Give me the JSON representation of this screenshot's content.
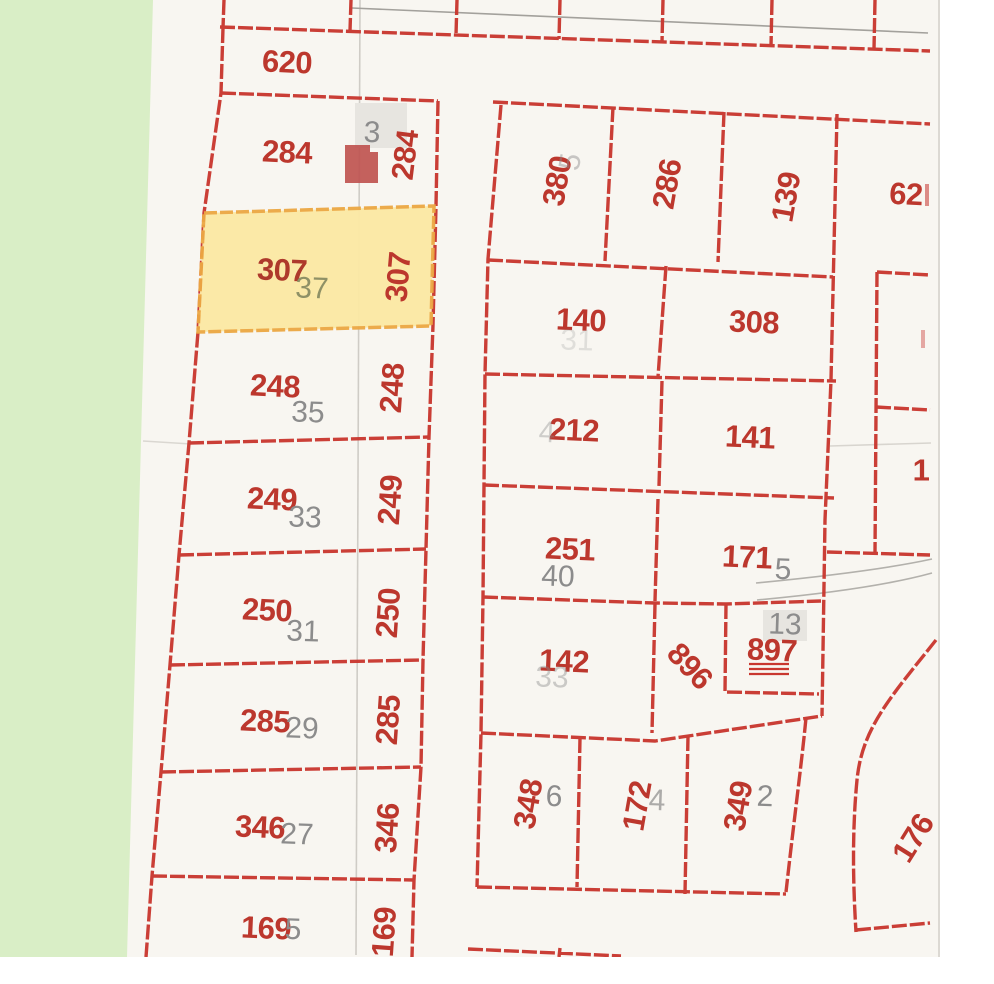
{
  "map": {
    "kind": "cadastral parcel map",
    "highlighted_parcel": {
      "parcel_number": "307",
      "house_number": "37"
    },
    "colors": {
      "map_background": "#f8f6f1",
      "parcel_line": "#c9372f",
      "parcel_label": "#bc372d",
      "house_number_label": "#8c8c8c",
      "house_number_on_highlight": "#8f9166",
      "highlight_fill": "#fce9a4",
      "highlight_border": "#eca843",
      "greenspace": "#d9eec6",
      "road_line": "#b3b1ac",
      "grid_line": "#cfccc6",
      "building_fill": "#bf5450"
    },
    "parcel_numbers": {
      "p620": "620",
      "p284": "284",
      "p284v": "284",
      "p307": "307",
      "p307v": "307",
      "p248": "248",
      "p248v": "248",
      "p249": "249",
      "p249v": "249",
      "p250": "250",
      "p250v": "250",
      "p285": "285",
      "p285v": "285",
      "p346": "346",
      "p346v": "346",
      "p169": "169",
      "p169v": "169",
      "p380": "380",
      "p286": "286",
      "p139": "139",
      "p62": "62",
      "p140": "140",
      "p308": "308",
      "p212": "212",
      "p141": "141",
      "p251": "251",
      "p171": "171",
      "p142": "142",
      "p896": "896",
      "p897": "897",
      "p348": "348",
      "p172": "172",
      "p349": "349",
      "p176": "176",
      "p1edge": "1"
    },
    "house_numbers": {
      "h37": "37",
      "h35": "35",
      "h33": "33",
      "h31": "31",
      "h29": "29",
      "h27": "27",
      "h25": "5",
      "h40": "40",
      "h5": "5",
      "h13": "13",
      "h6": "6",
      "h4": "4",
      "h2": "2",
      "h3": "3",
      "h380": "5",
      "h142": "33",
      "h212": "4",
      "h140": "31"
    }
  }
}
